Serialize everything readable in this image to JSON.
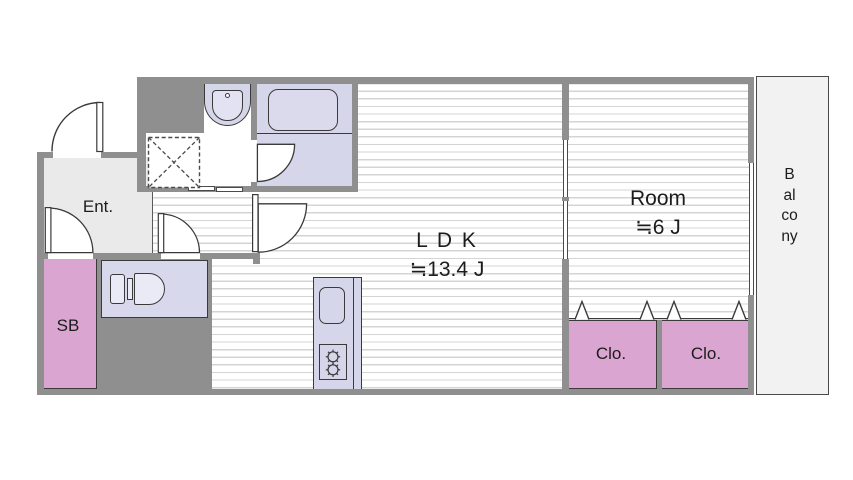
{
  "floorplan": {
    "rooms": {
      "entrance": {
        "label": "Ent."
      },
      "shoe_box": {
        "label": "SB"
      },
      "ldk": {
        "label": "L D K",
        "area": "≒13.4 J"
      },
      "bedroom": {
        "label": "Room",
        "area": "≒6 J"
      },
      "closet_left": {
        "label": "Clo."
      },
      "closet_right": {
        "label": "Clo."
      },
      "balcony": {
        "label": "Balcony"
      }
    },
    "fixtures": {
      "bathtub": "rounded-rect-tub",
      "washbasin": "bowl-with-faucet-dot",
      "washing_machine_space": "dashed-square-with-x",
      "toilet": "tank-and-bowl",
      "kitchen": "counter-with-sink-and-two-burner-stove",
      "doors": "quarter-circle-swing-arcs",
      "closet_doors": "chevron-fold-marks"
    },
    "colors": {
      "wall": "#8f8f8f",
      "wet_area_fill": "#d6d6ea",
      "fixture_fill": "#eaeaf6",
      "storage_pink": "#daa6d1",
      "entrance_gray": "#eaeaea",
      "balcony_gray": "#f2f2f2",
      "floor_line": "#d4d4d4",
      "outline": "#3a3a3a"
    }
  }
}
